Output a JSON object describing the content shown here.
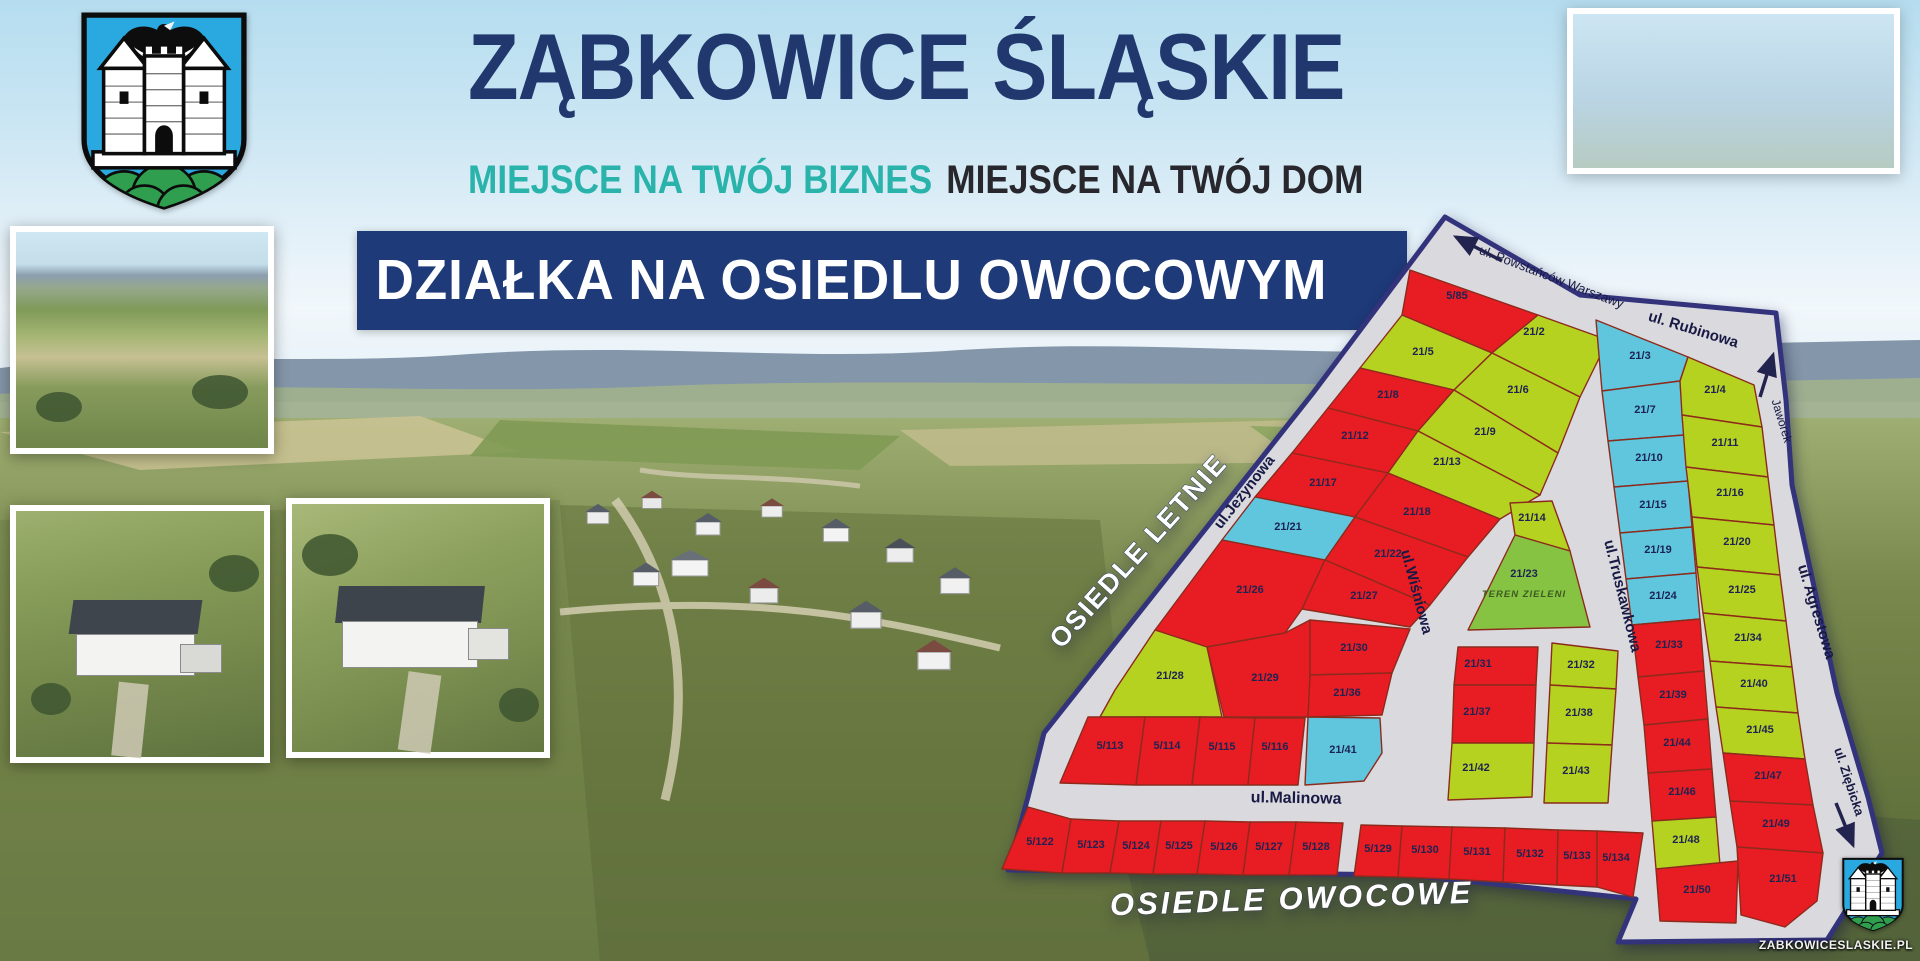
{
  "header": {
    "title": "ZĄBKOWICE ŚLĄSKIE",
    "subtitle_business": "MIEJSCE NA TWÓJ BIZNES",
    "subtitle_home": "MIEJSCE NA TWÓJ DOM",
    "banner": "DZIAŁKA NA OSIEDLU OWOCOWYM"
  },
  "branding": {
    "website": "ZABKOWICESLASKIE.PL"
  },
  "colors": {
    "title_navy": "#20386e",
    "teal": "#2ab3ab",
    "banner_navy": "#1e3a78",
    "map_base": "#d9d9de",
    "map_border": "#33337c",
    "plot_border": "#8c2b1c",
    "map_red": "#e81c23",
    "map_green": "#b6d221",
    "map_cyan": "#5fc6dd",
    "map_dgreen": "#86c343",
    "label_navy": "#1d2353"
  },
  "map": {
    "outline": "505,32 640,110 836,128 846,215 852,300 897,508 928,612 942,668 887,755 678,757 696,714 470,690 68,685 88,612 104,548 233,385 373,208",
    "areas": [
      {
        "label": "OSIEDLE LETNIE",
        "x": 205,
        "y": 372,
        "rotate": -48,
        "style": "estate"
      },
      {
        "label": "OSIEDLE OWOCOWE",
        "x": 352,
        "y": 724,
        "rotate": -2,
        "style": "estate-italic"
      }
    ],
    "streets": [
      {
        "name": "ul. Powstańców Warszawy",
        "x": 610,
        "y": 96,
        "rotate": 21,
        "size": 13,
        "weight": "normal"
      },
      {
        "name": "ul. Rubinowa",
        "x": 752,
        "y": 149,
        "rotate": 17,
        "size": 15,
        "weight": "bold"
      },
      {
        "name": "Jaworek",
        "x": 838,
        "y": 237,
        "rotate": 73,
        "size": 12,
        "weight": "normal"
      },
      {
        "name": "ul.Jeżynowa",
        "x": 308,
        "y": 310,
        "rotate": -52,
        "size": 15,
        "weight": "bold"
      },
      {
        "name": "ul.Wiśniowa",
        "x": 472,
        "y": 408,
        "rotate": 75,
        "size": 15,
        "weight": "bold"
      },
      {
        "name": "ul.Truskawkowa",
        "x": 678,
        "y": 412,
        "rotate": 76,
        "size": 15,
        "weight": "bold"
      },
      {
        "name": "ul. Agrestowa",
        "x": 872,
        "y": 428,
        "rotate": 73,
        "size": 15,
        "weight": "bold"
      },
      {
        "name": "ul.Malinowa",
        "x": 356,
        "y": 618,
        "rotate": 1,
        "size": 16,
        "weight": "bold"
      },
      {
        "name": "ul. Ziębicka",
        "x": 905,
        "y": 598,
        "rotate": 72,
        "size": 13,
        "weight": "bold"
      }
    ],
    "arrows": [
      {
        "x1": 562,
        "y1": 76,
        "x2": 516,
        "y2": 52
      },
      {
        "x1": 820,
        "y1": 212,
        "x2": 833,
        "y2": 170
      },
      {
        "x1": 896,
        "y1": 618,
        "x2": 913,
        "y2": 660
      }
    ],
    "plots": [
      {
        "id": "5/85",
        "color": "red",
        "points": "470,85 598,130 552,168 462,130",
        "lx": 517,
        "ly": 114
      },
      {
        "id": "21/2",
        "color": "green",
        "points": "598,130 668,155 640,212 552,168",
        "lx": 594,
        "ly": 150
      },
      {
        "id": "21/5",
        "color": "green",
        "points": "462,130 552,168 514,205 420,183",
        "lx": 483,
        "ly": 170
      },
      {
        "id": "21/6",
        "color": "green",
        "points": "552,168 640,212 618,268 514,205",
        "lx": 578,
        "ly": 208
      },
      {
        "id": "21/8",
        "color": "red",
        "points": "420,183 514,205 478,246 388,223",
        "lx": 448,
        "ly": 213
      },
      {
        "id": "21/9",
        "color": "green",
        "points": "514,205 618,268 600,310 478,246",
        "lx": 545,
        "ly": 250
      },
      {
        "id": "21/12",
        "color": "red",
        "points": "388,223 478,246 448,288 352,268",
        "lx": 415,
        "ly": 254
      },
      {
        "id": "21/13",
        "color": "green",
        "points": "478,246 600,310 560,334 448,288",
        "lx": 507,
        "ly": 280
      },
      {
        "id": "21/17",
        "color": "red",
        "points": "352,268 448,288 415,332 315,312",
        "lx": 383,
        "ly": 301
      },
      {
        "id": "21/18",
        "color": "red",
        "points": "448,288 560,334 528,372 415,332",
        "lx": 477,
        "ly": 330
      },
      {
        "id": "21/21",
        "color": "cyan",
        "points": "315,312 415,332 385,375 282,355",
        "lx": 348,
        "ly": 345
      },
      {
        "id": "21/22",
        "color": "red",
        "points": "415,332 528,372 490,420 385,375",
        "lx": 448,
        "ly": 372
      },
      {
        "id": "21/26",
        "color": "red",
        "points": "282,355 385,375 362,424 345,448 267,462 215,445 250,398",
        "lx": 310,
        "ly": 408
      },
      {
        "id": "21/27",
        "color": "red",
        "points": "385,375 490,420 470,442 362,424",
        "lx": 424,
        "ly": 414
      },
      {
        "id": "21/28",
        "color": "green",
        "points": "215,445 267,462 282,532 160,532 175,505",
        "lx": 230,
        "ly": 494
      },
      {
        "id": "21/29",
        "color": "red",
        "points": "267,462 345,448 370,435 370,532 284,532",
        "lx": 325,
        "ly": 496
      },
      {
        "id": "21/30",
        "color": "red",
        "points": "370,435 470,444 452,488 370,490",
        "lx": 414,
        "ly": 466
      },
      {
        "id": "21/36",
        "color": "red",
        "points": "370,490 452,488 442,530 368,532",
        "lx": 407,
        "ly": 511
      },
      {
        "id": "21/41",
        "color": "cyan",
        "points": "368,532 440,533 442,568 424,596 365,600",
        "lx": 403,
        "ly": 568
      },
      {
        "id": "5/113",
        "color": "red",
        "points": "148,532 205,532 196,600 120,598",
        "lx": 170,
        "ly": 564
      },
      {
        "id": "5/114",
        "color": "red",
        "points": "205,532 260,532 252,600 196,600",
        "lx": 227,
        "ly": 564
      },
      {
        "id": "5/115",
        "color": "red",
        "points": "260,532 315,533 308,600 252,600",
        "lx": 282,
        "ly": 565
      },
      {
        "id": "5/116",
        "color": "red",
        "points": "315,533 365,533 358,600 308,600",
        "lx": 335,
        "ly": 565
      },
      {
        "id": "21/14",
        "color": "green",
        "points": "570,318 612,316 630,366 575,350",
        "lx": 592,
        "ly": 336
      },
      {
        "id": "21/23",
        "color": "dgreen",
        "points": "575,350 630,366 650,442 528,445",
        "lx": 584,
        "ly": 392,
        "sub": "TEREN ZIELENI",
        "sx": 584,
        "sy": 412
      },
      {
        "id": "21/31",
        "color": "red",
        "points": "518,462 598,462 596,500 514,500",
        "lx": 538,
        "ly": 482
      },
      {
        "id": "21/37",
        "color": "red",
        "points": "514,500 596,500 594,558 512,558",
        "lx": 537,
        "ly": 530
      },
      {
        "id": "21/42",
        "color": "green",
        "points": "512,558 594,558 592,612 508,615",
        "lx": 536,
        "ly": 586
      },
      {
        "id": "21/32",
        "color": "green",
        "points": "612,458 678,466 676,504 610,500",
        "lx": 641,
        "ly": 483
      },
      {
        "id": "21/38",
        "color": "green",
        "points": "610,500 676,504 672,560 607,558",
        "lx": 639,
        "ly": 531
      },
      {
        "id": "21/43",
        "color": "green",
        "points": "607,558 672,560 668,618 604,618",
        "lx": 636,
        "ly": 589
      },
      {
        "id": "21/3",
        "color": "cyan",
        "points": "656,135 748,172 740,196 662,206",
        "lx": 700,
        "ly": 174
      },
      {
        "id": "21/7",
        "color": "cyan",
        "points": "662,206 740,196 744,250 668,256",
        "lx": 705,
        "ly": 228
      },
      {
        "id": "21/10",
        "color": "cyan",
        "points": "668,256 744,250 748,296 674,302",
        "lx": 709,
        "ly": 276
      },
      {
        "id": "21/15",
        "color": "cyan",
        "points": "674,302 748,296 752,342 680,348",
        "lx": 713,
        "ly": 323
      },
      {
        "id": "21/19",
        "color": "cyan",
        "points": "680,348 752,342 756,388 686,394",
        "lx": 718,
        "ly": 368
      },
      {
        "id": "21/24",
        "color": "cyan",
        "points": "686,394 756,388 760,434 692,440",
        "lx": 723,
        "ly": 414
      },
      {
        "id": "21/33",
        "color": "red",
        "points": "692,440 760,434 764,486 698,492",
        "lx": 729,
        "ly": 463
      },
      {
        "id": "21/39",
        "color": "red",
        "points": "698,492 764,486 768,534 704,540",
        "lx": 733,
        "ly": 513
      },
      {
        "id": "21/44",
        "color": "red",
        "points": "704,540 768,534 772,584 708,588",
        "lx": 737,
        "ly": 561
      },
      {
        "id": "21/46",
        "color": "red",
        "points": "708,588 772,584 776,632 712,636",
        "lx": 742,
        "ly": 610
      },
      {
        "id": "21/48",
        "color": "green",
        "points": "712,636 776,632 780,680 716,684",
        "lx": 746,
        "ly": 658
      },
      {
        "id": "21/50",
        "color": "red",
        "points": "716,684 798,676 796,738 720,736",
        "lx": 757,
        "ly": 708
      },
      {
        "id": "21/4",
        "color": "green",
        "points": "748,172 814,200 822,242 742,230 740,196",
        "lx": 775,
        "ly": 208
      },
      {
        "id": "21/11",
        "color": "green",
        "points": "742,230 822,242 828,292 746,282",
        "lx": 785,
        "ly": 261
      },
      {
        "id": "21/16",
        "color": "green",
        "points": "746,282 828,292 834,340 752,332",
        "lx": 790,
        "ly": 311
      },
      {
        "id": "21/20",
        "color": "green",
        "points": "752,332 834,340 840,390 757,382",
        "lx": 797,
        "ly": 360
      },
      {
        "id": "21/25",
        "color": "green",
        "points": "757,382 840,390 846,436 763,428",
        "lx": 802,
        "ly": 408
      },
      {
        "id": "21/34",
        "color": "green",
        "points": "763,428 846,436 852,482 770,476",
        "lx": 808,
        "ly": 456
      },
      {
        "id": "21/40",
        "color": "green",
        "points": "770,476 852,482 858,528 776,522",
        "lx": 814,
        "ly": 502
      },
      {
        "id": "21/45",
        "color": "green",
        "points": "776,522 858,528 865,574 783,568",
        "lx": 820,
        "ly": 548
      },
      {
        "id": "21/47",
        "color": "red",
        "points": "783,568 865,574 873,620 790,616",
        "lx": 828,
        "ly": 594
      },
      {
        "id": "21/49",
        "color": "red",
        "points": "790,616 873,620 883,668 797,662",
        "lx": 836,
        "ly": 642
      },
      {
        "id": "21/51",
        "color": "red",
        "points": "797,662 883,668 877,716 845,742 801,730",
        "lx": 843,
        "ly": 697
      },
      {
        "id": "5/122",
        "color": "red",
        "points": "88,622 131,634 122,688 62,684",
        "lx": 100,
        "ly": 660
      },
      {
        "id": "5/123",
        "color": "red",
        "points": "131,634 179,636 170,688 122,688",
        "lx": 151,
        "ly": 663
      },
      {
        "id": "5/124",
        "color": "red",
        "points": "179,636 221,636 213,689 170,688",
        "lx": 196,
        "ly": 664
      },
      {
        "id": "5/125",
        "color": "red",
        "points": "221,636 265,636 257,689 213,689",
        "lx": 239,
        "ly": 664
      },
      {
        "id": "5/126",
        "color": "red",
        "points": "265,636 310,637 303,690 257,689",
        "lx": 284,
        "ly": 665
      },
      {
        "id": "5/127",
        "color": "red",
        "points": "310,637 356,637 349,690 303,690",
        "lx": 329,
        "ly": 665
      },
      {
        "id": "5/128",
        "color": "red",
        "points": "356,637 403,638 397,690 349,690",
        "lx": 376,
        "ly": 665
      },
      {
        "id": "5/129",
        "color": "red",
        "points": "421,640 462,641 458,692 414,691",
        "lx": 438,
        "ly": 667
      },
      {
        "id": "5/130",
        "color": "red",
        "points": "462,641 512,642 509,694 458,692",
        "lx": 485,
        "ly": 668
      },
      {
        "id": "5/131",
        "color": "red",
        "points": "512,642 565,643 563,697 509,694",
        "lx": 537,
        "ly": 670
      },
      {
        "id": "5/132",
        "color": "red",
        "points": "565,643 618,645 617,700 563,697",
        "lx": 590,
        "ly": 672
      },
      {
        "id": "5/133",
        "color": "red",
        "points": "618,645 657,646 657,702 617,700",
        "lx": 637,
        "ly": 674
      },
      {
        "id": "5/134",
        "color": "red",
        "points": "657,646 703,648 693,712 657,702",
        "lx": 676,
        "ly": 676
      }
    ]
  }
}
